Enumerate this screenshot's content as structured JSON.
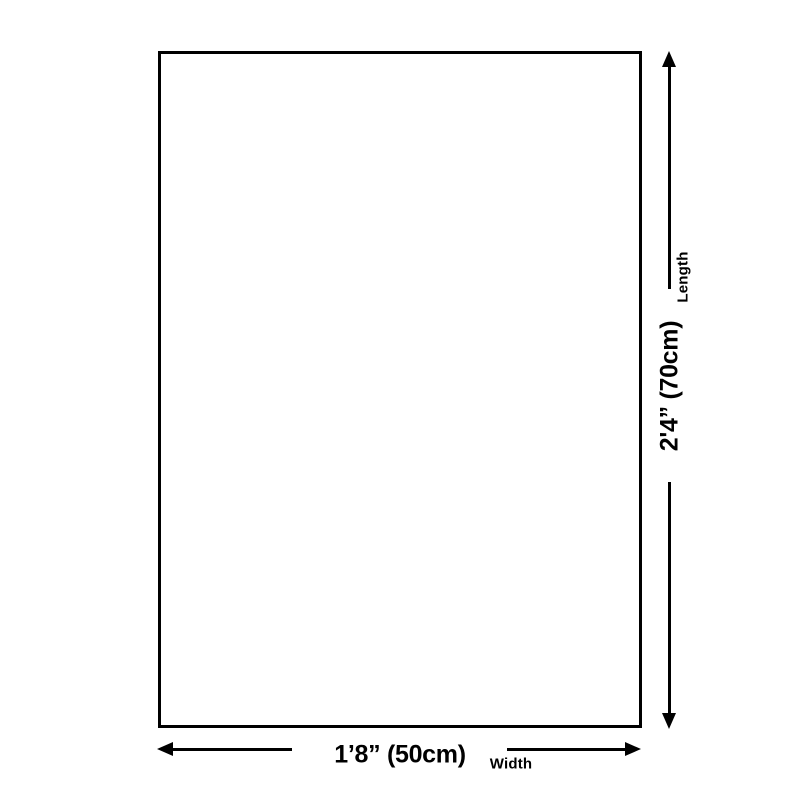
{
  "page": {
    "background_color": "#ffffff"
  },
  "diagram": {
    "line_color": "#000000",
    "shape": "rectangle",
    "length_dimension": {
      "value": "2'4” (70cm)",
      "label": "Length"
    },
    "width_dimension": {
      "value": "1’8” (50cm)",
      "label": "Width"
    }
  }
}
